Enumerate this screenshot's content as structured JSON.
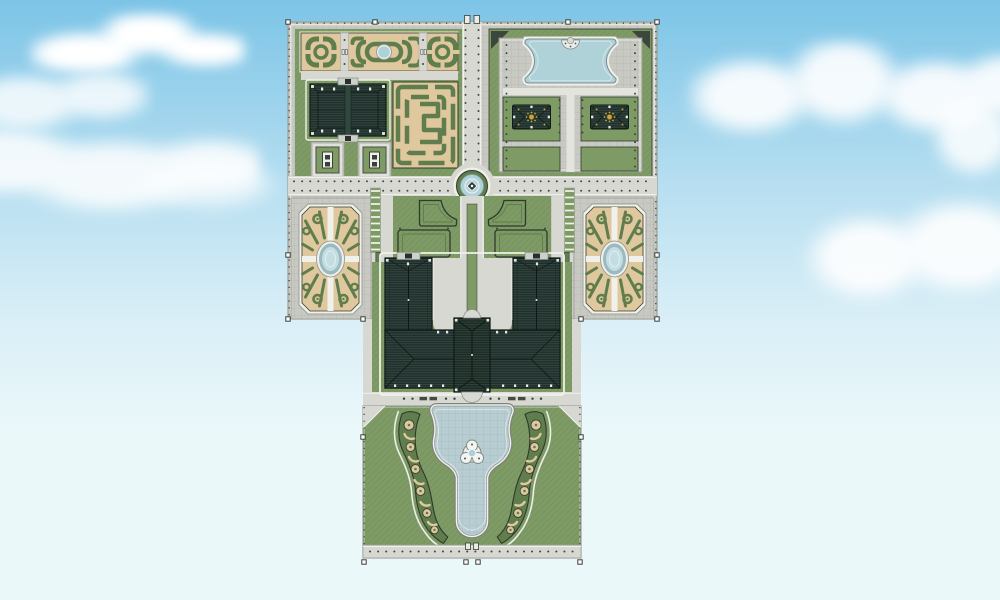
{
  "palette": {
    "sky_top": "#7cc4e7",
    "sky_mid": "#b5def0",
    "sky_low": "#d8eef7",
    "sky_bottom": "#ebf8fa",
    "cloud": "#ffffff",
    "lawn": "#7e9a65",
    "hedge": "#5f7d4d",
    "hedge_dark": "#2f3b2c",
    "sand": "#e0c89e",
    "water": "#aed2d8",
    "water_light": "#c3dee2",
    "water_ring": "#9cb9bf",
    "pool_paving": "#b7cdd1",
    "roof": "#233530",
    "roof_dark": "#1f3029",
    "roof_line": "#0c1712",
    "path": "#d8d8d3",
    "path_light": "#e4e4df",
    "stone_white": "#f1f1ec",
    "cobble": "#c9c9c3",
    "gold": "#c9a33c",
    "post": "#3f453d",
    "trim": "#9aa096",
    "chip": "#e9ebe7"
  },
  "scene": {
    "type": "aerial-site-plan",
    "sky_clouds": 7,
    "blocks": [
      "north-garden-block",
      "palace-block",
      "south-garden-block"
    ],
    "regions": [
      {
        "name": "north-parterre-beds",
        "count": 3
      },
      {
        "name": "chateau-outbuilding",
        "count": 1
      },
      {
        "name": "service-pavilions",
        "count": 2
      },
      {
        "name": "hedge-maze-parterre",
        "count": 1
      },
      {
        "name": "great-basin",
        "count": 1
      },
      {
        "name": "garden-pavilions-gilded",
        "count": 2
      },
      {
        "name": "rond-point-fountain",
        "count": 1
      },
      {
        "name": "west-bosquet-oval-pool",
        "count": 1
      },
      {
        "name": "east-bosquet-oval-pool",
        "count": 1
      },
      {
        "name": "forecourt-parterres",
        "count": 4
      },
      {
        "name": "palace-wings",
        "count": 2
      },
      {
        "name": "palace-corps-de-logis",
        "count": 1
      },
      {
        "name": "south-terrace",
        "count": 1
      },
      {
        "name": "south-fountain-pool",
        "count": 1
      },
      {
        "name": "scroll-parterres",
        "count": 2
      },
      {
        "name": "great-lawn",
        "count": 1
      }
    ],
    "selection_handles": 16
  }
}
